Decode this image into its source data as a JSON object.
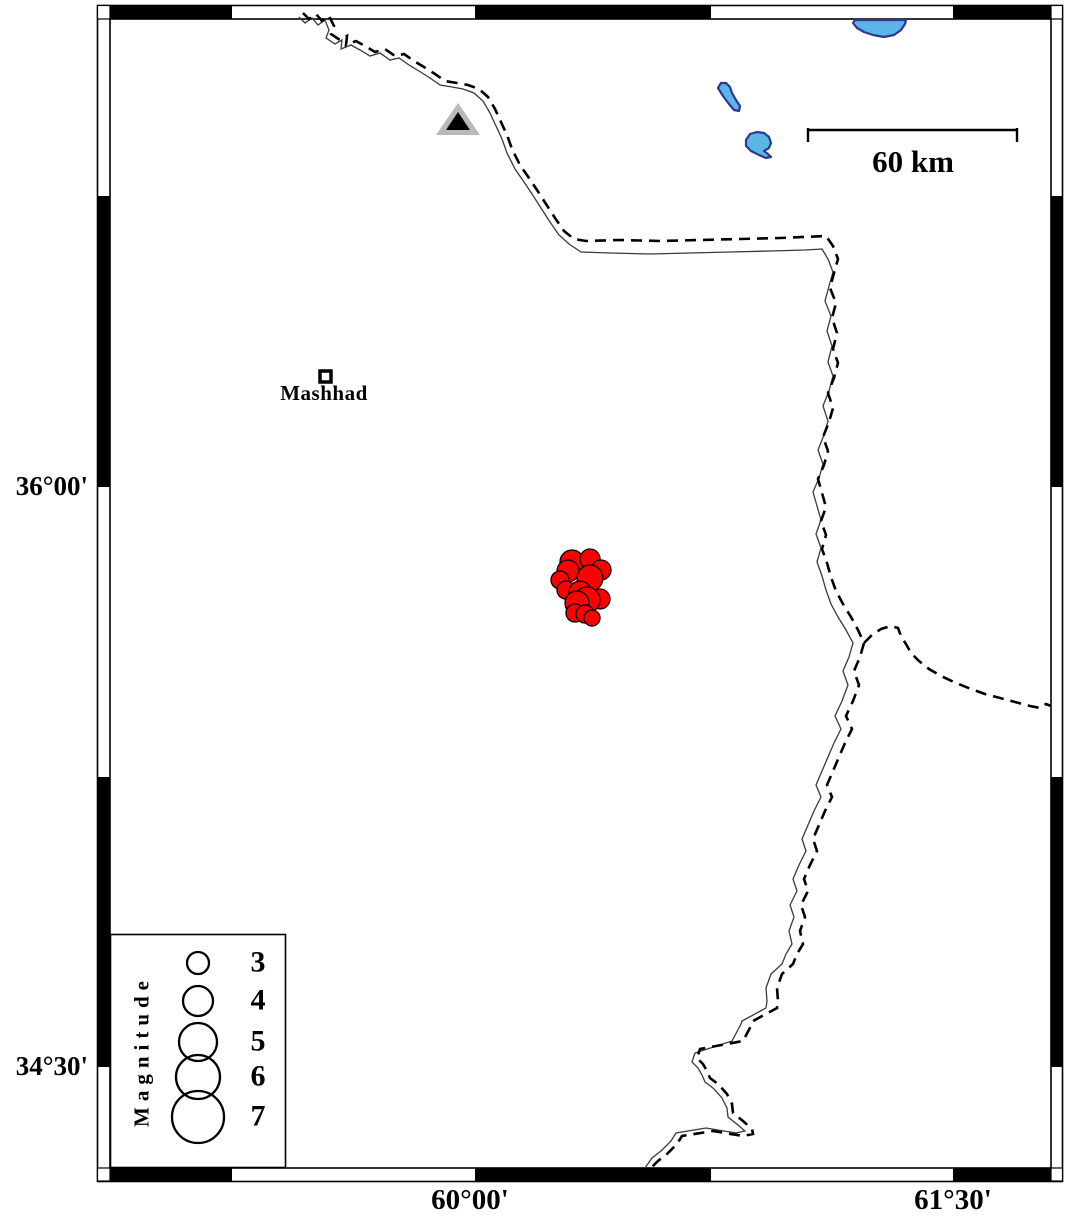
{
  "map_frame": {
    "lat_annotations": [
      {
        "text": "36°00'"
      },
      {
        "text": "34°30'"
      }
    ],
    "lon_annotations": [
      {
        "text": "60°00'"
      },
      {
        "text": "61°30'"
      }
    ]
  },
  "city": {
    "label": "Mashhad"
  },
  "scale_bar": {
    "label": "60 km"
  },
  "station": {
    "symbol": "triangle",
    "fill": "#b9b9b9",
    "inner_fill": "#000000"
  },
  "legend": {
    "title": "Magnitude",
    "entries": [
      {
        "label": "3",
        "radius_px": 11
      },
      {
        "label": "4",
        "radius_px": 15
      },
      {
        "label": "5",
        "radius_px": 19
      },
      {
        "label": "6",
        "radius_px": 22
      },
      {
        "label": "7",
        "radius_px": 26
      }
    ]
  },
  "lakes": {
    "fill": "#5db4e6",
    "stroke": "#2b3990"
  },
  "borders": {
    "style": "dashed political boundary with thin river line"
  },
  "earthquakes": {
    "fill": "#ff0000",
    "stroke": "#000000",
    "points": [
      {
        "x": 572,
        "y": 562,
        "r": 12
      },
      {
        "x": 590,
        "y": 559,
        "r": 10
      },
      {
        "x": 601,
        "y": 570,
        "r": 10
      },
      {
        "x": 568,
        "y": 571,
        "r": 11
      },
      {
        "x": 560,
        "y": 580,
        "r": 9
      },
      {
        "x": 566,
        "y": 590,
        "r": 9
      },
      {
        "x": 590,
        "y": 578,
        "r": 13
      },
      {
        "x": 580,
        "y": 592,
        "r": 11
      },
      {
        "x": 600,
        "y": 599,
        "r": 10
      },
      {
        "x": 587,
        "y": 600,
        "r": 13
      },
      {
        "x": 577,
        "y": 603,
        "r": 12
      },
      {
        "x": 575,
        "y": 613,
        "r": 9
      },
      {
        "x": 585,
        "y": 614,
        "r": 9
      },
      {
        "x": 592,
        "y": 618,
        "r": 8
      }
    ]
  }
}
